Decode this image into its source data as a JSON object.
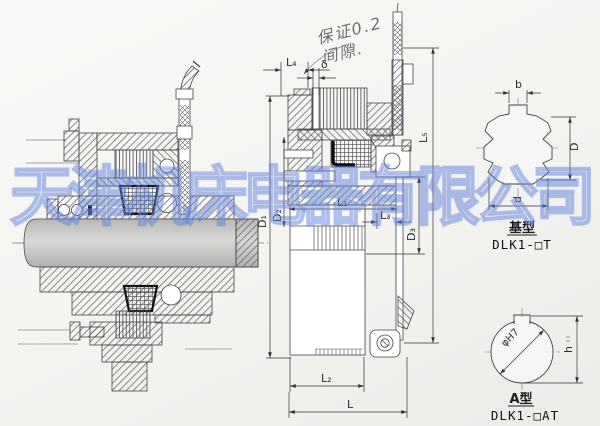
{
  "page": {
    "type": "scanned engineering drawing",
    "background": "#f3f3f0"
  },
  "watermark": {
    "text": "天津机床电器有限公司",
    "color": "#6484dc"
  },
  "handwriting": {
    "line1": "保证0.2",
    "line2": "间隙."
  },
  "middle_view": {
    "dim_l4": "L₄",
    "dim_delta": "δ",
    "dim_l5": "L₅",
    "dim_l1": "L₁",
    "dim_l3": "L₃",
    "dim_d1": "D₁",
    "dim_d2": "D₂",
    "dim_d3": "D₃",
    "dim_l2": "L₂",
    "dim_l": "L"
  },
  "basic_type_view": {
    "title": "基型",
    "model": "DLK1-□T",
    "dim_b": "b",
    "dim_big_d": "D",
    "dim_small_d": "d"
  },
  "a_type_view": {
    "title": "A型",
    "model": "DLK1-□AT",
    "dim_phi": "φH7",
    "dim_h": "h"
  }
}
